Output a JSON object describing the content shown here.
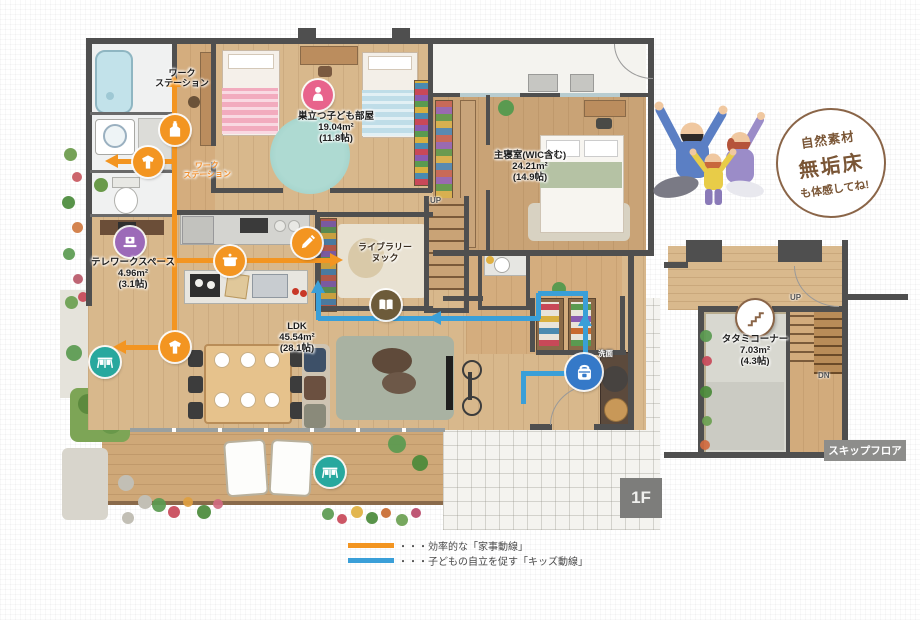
{
  "plan": {
    "floor_tag": "1F",
    "labels": {
      "workstation_l1": "ワーク",
      "workstation_l2": "ステーション",
      "workstation_stamp_l1": "ワーク",
      "workstation_stamp_l2": "ステーション",
      "kids_name": "巣立つ子ども部屋",
      "kids_area": "19.04m²",
      "kids_jo": "(11.8帖)",
      "master_name": "主寝室(WIC含む)",
      "master_area": "24.21m²",
      "master_jo": "(14.9帖)",
      "telework_name": "テレワークスペース",
      "telework_area": "4.96m²",
      "telework_jo": "(3.1帖)",
      "ldk_name": "LDK",
      "ldk_area": "45.54m²",
      "ldk_jo": "(28.1帖)",
      "library_l1": "ライブラリー",
      "library_l2": "ヌック",
      "washroom": "洗面",
      "up": "UP"
    }
  },
  "skip_floor": {
    "tag": "スキップフロア",
    "tatami_name": "タタミコーナー",
    "tatami_area": "7.03m²",
    "tatami_jo": "(4.3帖)",
    "up": "UP",
    "dn": "DN"
  },
  "badge": {
    "l1": "自然素材",
    "l2": "無垢床",
    "l3": "も体感してね!"
  },
  "legend": {
    "house_route": "・・・効率的な「家事動線」",
    "kids_route": "・・・子どもの自立を促す「キッズ動線」"
  },
  "icons": {
    "detergent": "detergent-bottle-icon",
    "laundry": "laundry-shirt-icon",
    "pot": "cooking-pot-icon",
    "pencil": "pencil-icon",
    "person": "child-icon",
    "laptop": "laptop-icon",
    "book": "open-book-icon",
    "drying": "drying-table-icon",
    "bag": "school-bag-icon",
    "stairs": "skip-stairs-icon"
  },
  "colors": {
    "house_route": "#f39521",
    "kids_route": "#3a9fd8",
    "wall": "#4f4f4f",
    "wood": "#d8b88c",
    "deck": "#cfa878",
    "pink": "#e8638c",
    "purple": "#9c6ab8",
    "teal": "#28a89e",
    "blue": "#3579c8",
    "book_brown": "#6d5b3a",
    "badge_brown": "#8a6548"
  }
}
